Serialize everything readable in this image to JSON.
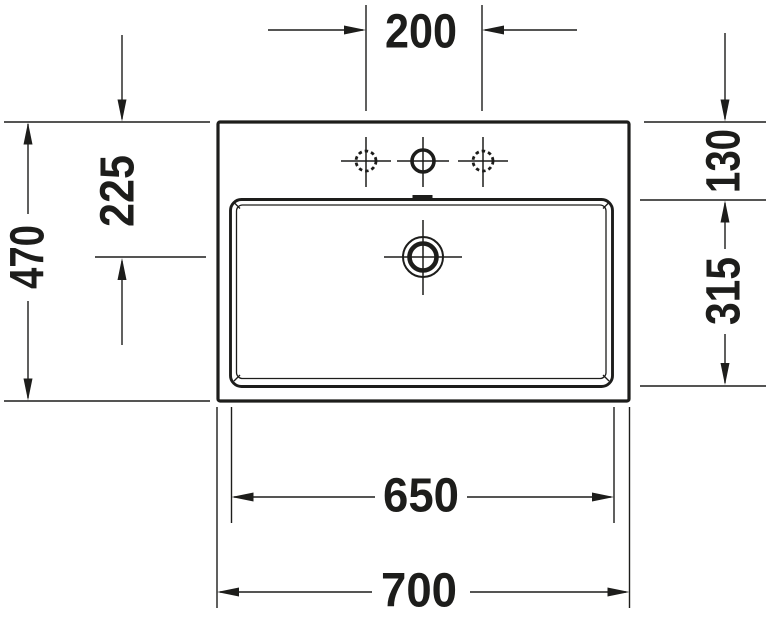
{
  "drawing": {
    "line_color": "#1d1d1b",
    "background_color": "#ffffff",
    "dimensions": {
      "tap_hole_spacing": "200",
      "overall_depth": "470",
      "drain_center_from_back": "225",
      "basin_rim_from_back": "130",
      "basin_depth": "315",
      "basin_width": "650",
      "overall_width": "700"
    }
  }
}
